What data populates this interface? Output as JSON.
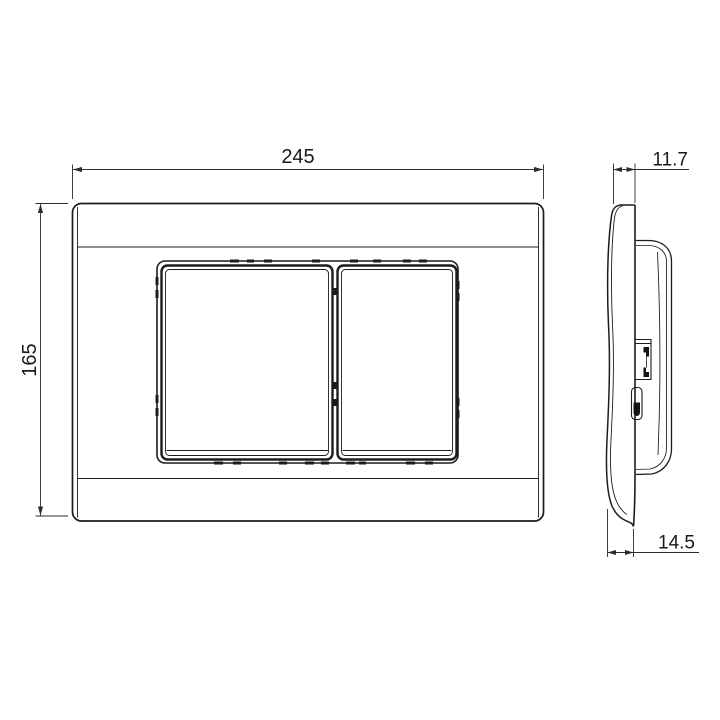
{
  "drawing": {
    "kind": "technical-dimension-drawing",
    "views": {
      "front": {
        "name": "front-view",
        "button_count": 2
      },
      "side": {
        "name": "side-profile-view"
      }
    },
    "dimensions": {
      "width": "245",
      "height": "165",
      "depth_top": "11.7",
      "depth_bottom": "14.5"
    },
    "colors": {
      "object_line": "#1c1c1c",
      "dimension_line": "#2d2d2d",
      "background": "#ffffff"
    }
  }
}
